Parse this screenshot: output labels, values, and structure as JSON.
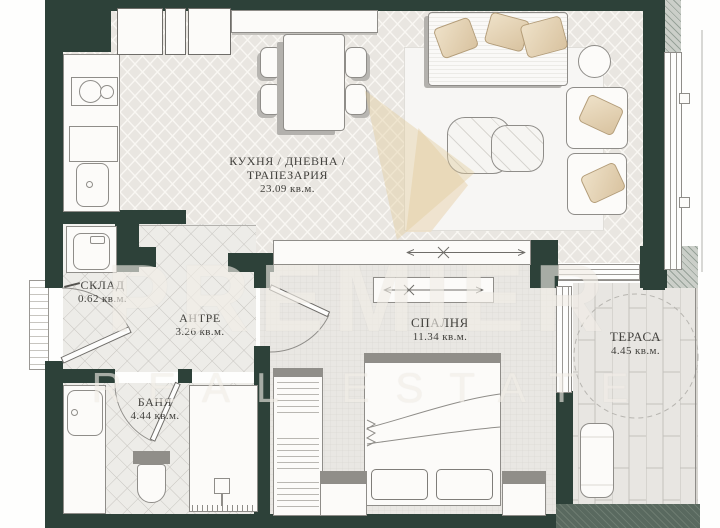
{
  "watermark": {
    "line1": "PREMIER",
    "line2": "REAL ESTATE"
  },
  "rooms": {
    "kitchen_living": {
      "name_line1": "КУХНЯ / ДНЕВНА /",
      "name_line2": "ТРАПЕЗАРИЯ",
      "area": "23.09 кв.м."
    },
    "storage": {
      "name": "СКЛАД",
      "area": "0.62 кв.м."
    },
    "hall": {
      "name": "АНТРЕ",
      "area": "3.26 кв.м."
    },
    "bathroom": {
      "name": "БАНЯ",
      "area": "4.44 кв.м."
    },
    "bedroom": {
      "name": "СПАЛНЯ",
      "area": "11.34 кв.м."
    },
    "terrace": {
      "name": "ТЕРАСА",
      "area": "4.45 кв.м."
    }
  },
  "colors": {
    "wall": "#2d4139",
    "watermark": "#f2eee7",
    "pillow": "#d9c3a0",
    "label_text": "#43423e",
    "furniture_line": "#8f8d89"
  }
}
